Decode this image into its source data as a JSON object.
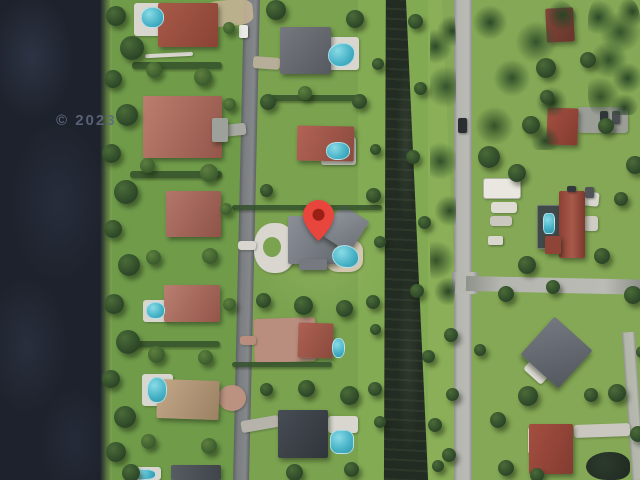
{
  "map": {
    "watermark": "© 2023",
    "marker": {
      "label": "selected-location-pin",
      "color": "#E8453C",
      "inner_color": "#9A1F15"
    },
    "colors": {
      "lake_water": "#1E222C",
      "canal_water": "#232C22",
      "grass": "#7AA24F",
      "tree_dark": "#2B4527",
      "road_asphalt": "#75787A",
      "road_concrete": "#B4B6AF",
      "roof_red": "#9E4E40",
      "roof_pink": "#B4766A",
      "roof_gray": "#84888F",
      "roof_dark": "#42484E",
      "roof_tan": "#BFA485",
      "pool_water": "#4AB4C8",
      "deck_white": "#D8D6CF",
      "paver": "#B98E7E"
    }
  }
}
